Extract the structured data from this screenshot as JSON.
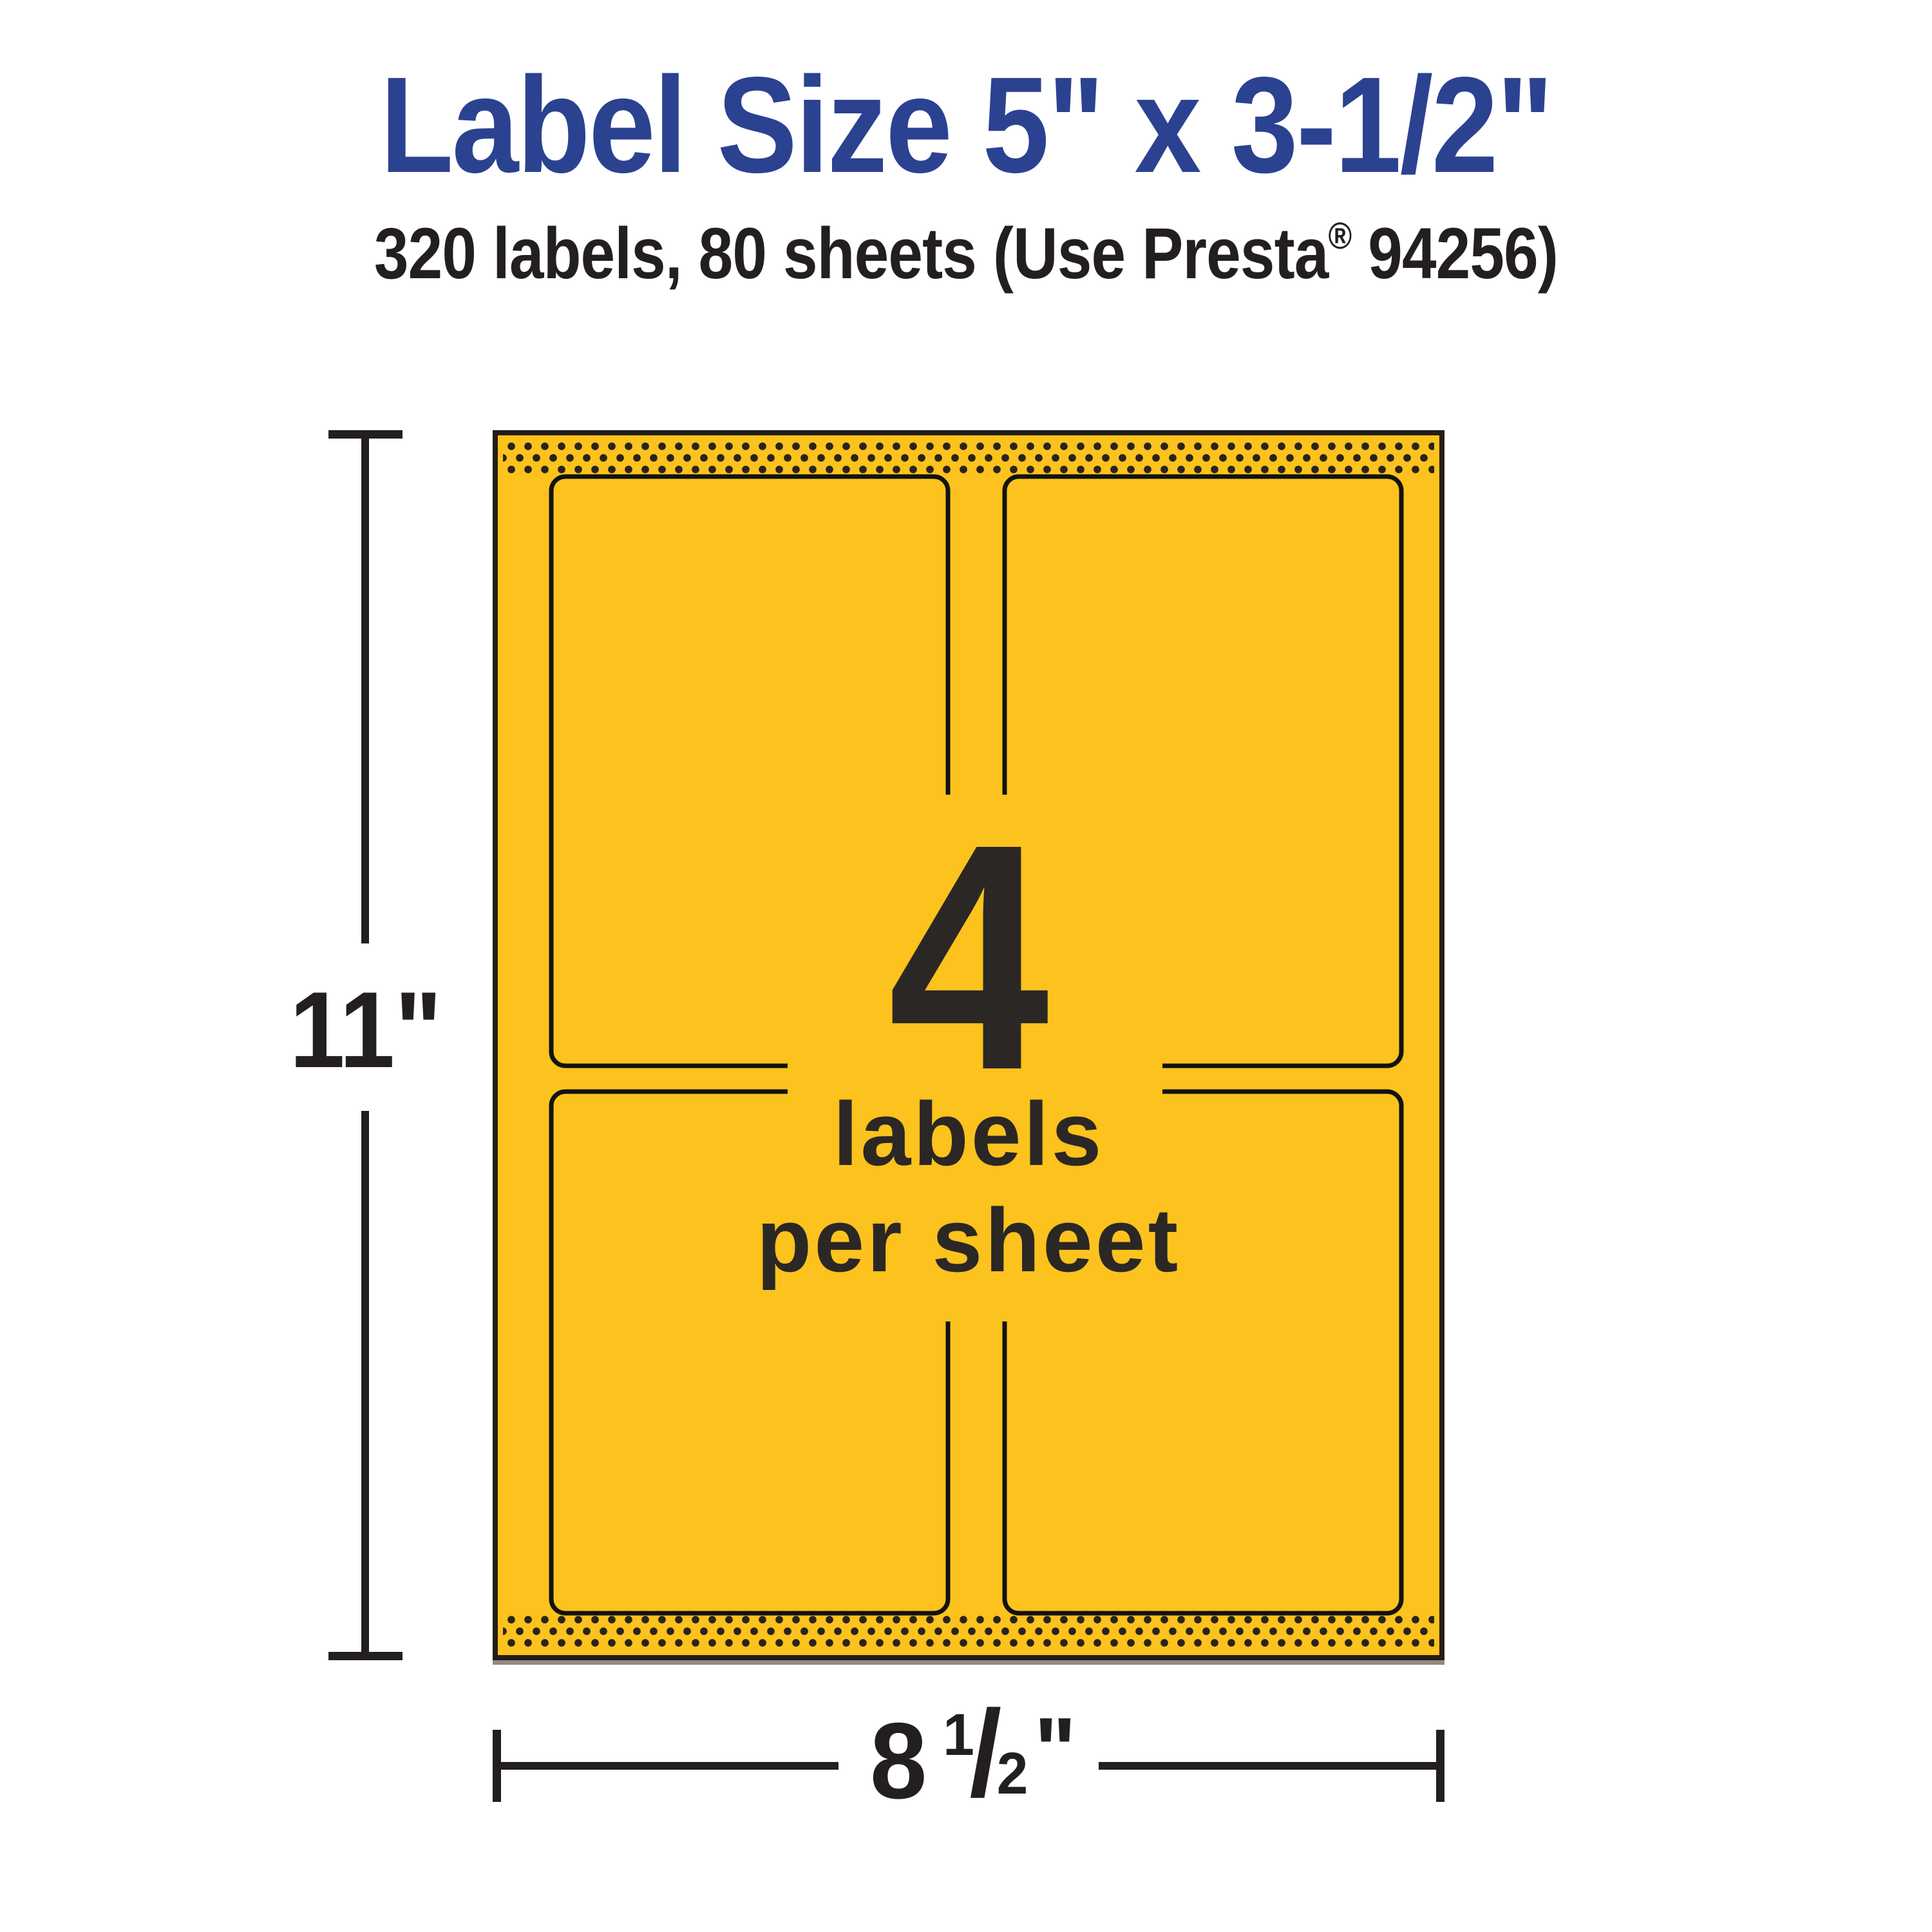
{
  "heading": {
    "title": "Label Size 5\" x 3-1/2\"",
    "title_color": "#2B4291",
    "subtitle_prefix": "320 labels, 80 sheets (Use Presta",
    "subtitle_reg_mark": "®",
    "subtitle_suffix": " 94256)"
  },
  "sheet": {
    "count": "4",
    "caption_line1": "labels",
    "caption_line2": "per sheet",
    "labels_per_sheet": 4,
    "paper_color": "#FCC21E",
    "border_color": "#241D16",
    "label_outline_color": "#121212",
    "perforation_dot_color": "#2A231B",
    "text_color": "#2B2724"
  },
  "dimensions": {
    "height_value": "11\"",
    "width_whole": "8",
    "width_frac_numerator": "1",
    "width_frac_slash": "/",
    "width_frac_denominator": "2",
    "width_inch_mark": "\"",
    "ink_color": "#231F20"
  }
}
